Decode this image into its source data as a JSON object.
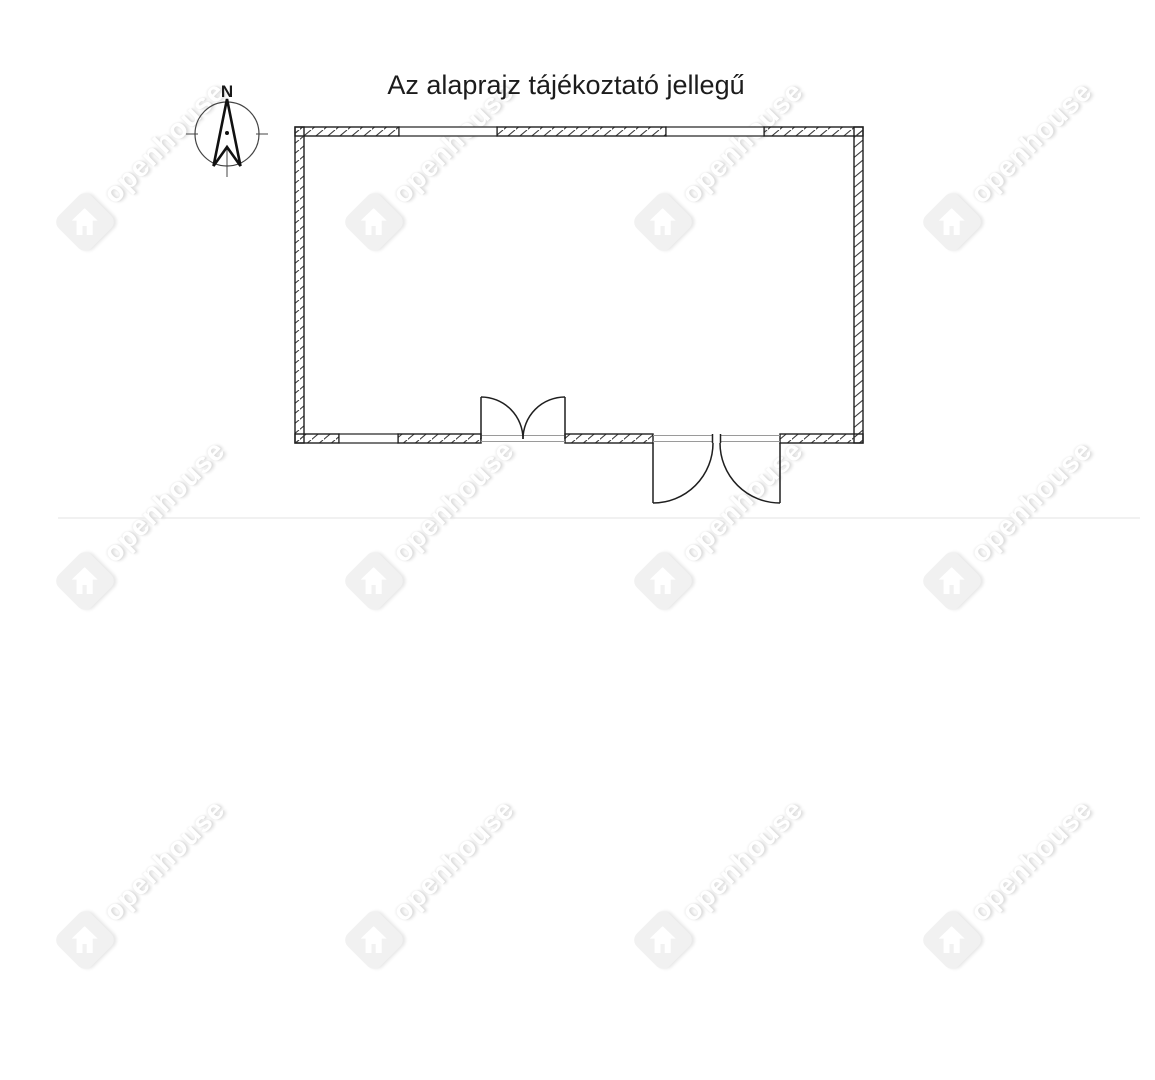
{
  "title": {
    "text": "Az alaprajz tájékoztató jellegű"
  },
  "compass": {
    "north_label": "N"
  },
  "watermark": {
    "text": "openhouse",
    "logo": "diamond-house-logo"
  },
  "colors": {
    "background": "#ffffff",
    "ink": "#1f1f1f",
    "threshold_gray": "#9a9a9a",
    "watermark_fill": "#f1f1f1",
    "divider": "#f1f1f1"
  },
  "floor_plan": {
    "kind": "single-room-outline",
    "walls": "hatched exterior walls",
    "windows_count": 3,
    "doors": [
      {
        "type": "double-door",
        "swing": "inward",
        "location": "bottom-wall-center"
      },
      {
        "type": "double-door",
        "swing": "outward",
        "location": "bottom-wall-right"
      }
    ]
  }
}
